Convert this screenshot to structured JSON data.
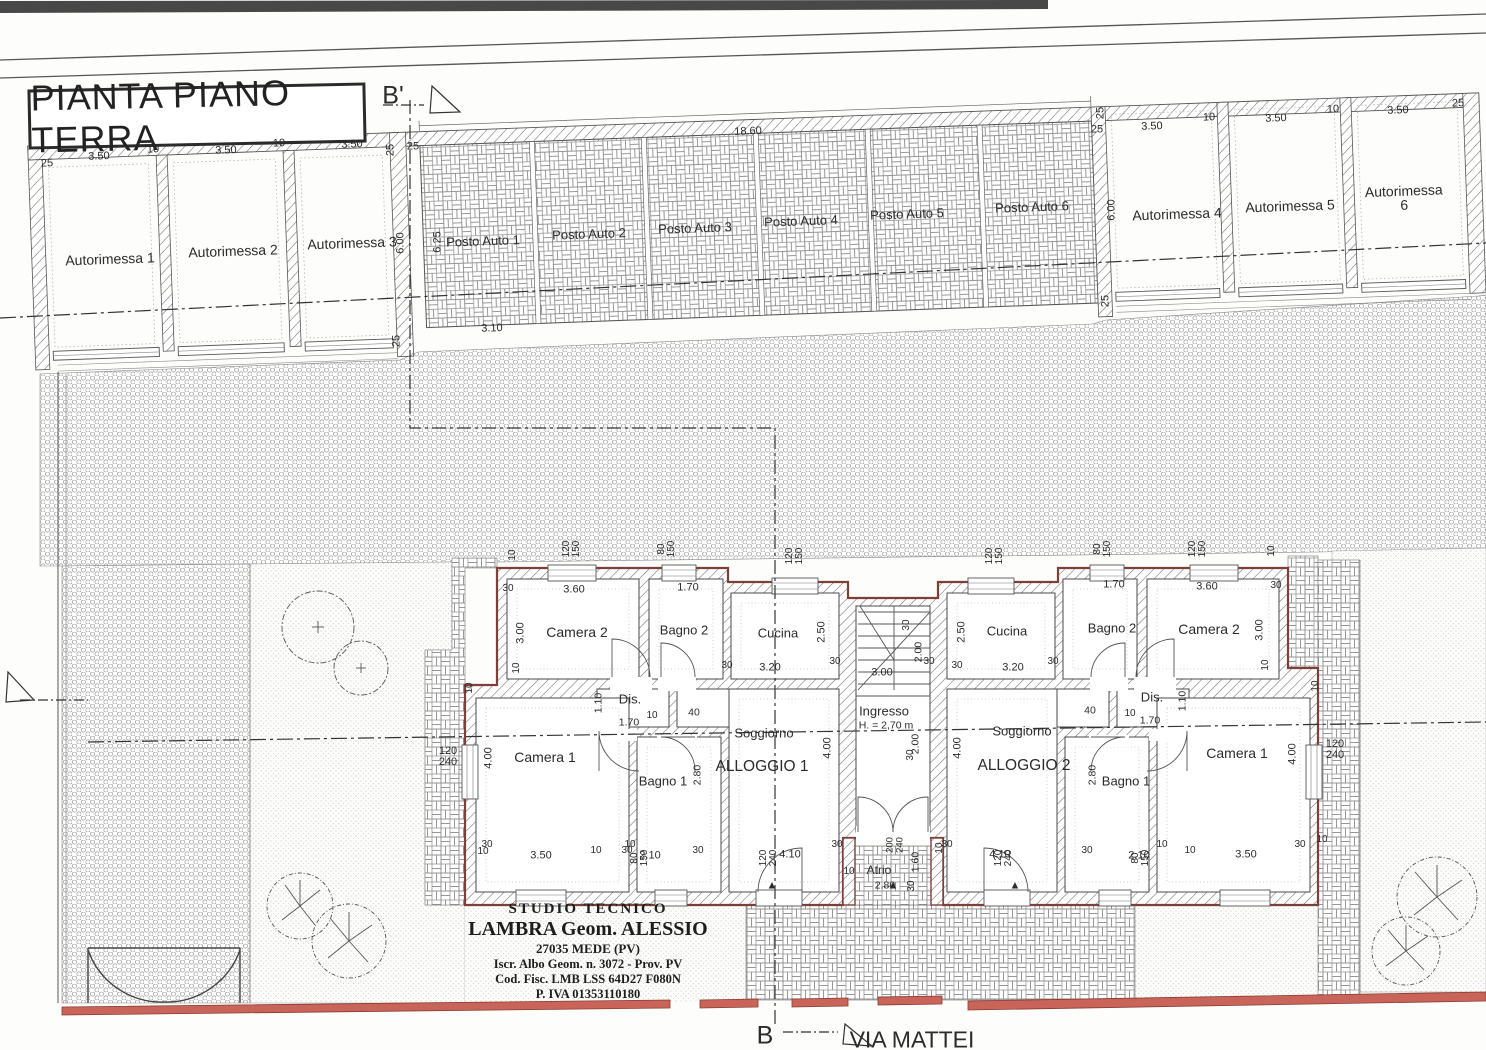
{
  "title": "PIANTA PIANO TERRA",
  "street": "VIA MATTEI",
  "section_markers": {
    "top": "B'",
    "bottom": "B"
  },
  "studio": {
    "line1": "STUDIO TECNICO",
    "line2": "LAMBRA Geom. ALESSIO",
    "line3": "27035 MEDE (PV)",
    "line4": "Iscr. Albo Geom. n. 3072 - Prov. PV",
    "line5": "Cod. Fisc. LMB LSS 64D27 F080N",
    "line6": "P. IVA 01353110180"
  },
  "garages": [
    "Autorimessa 1",
    "Autorimessa 2",
    "Autorimessa 3",
    "Autorimessa 4",
    "Autorimessa 5",
    "Autorimessa 6"
  ],
  "parking_spots": [
    "Posto Auto 1",
    "Posto Auto 2",
    "Posto Auto 3",
    "Posto Auto 4",
    "Posto Auto 5",
    "Posto Auto 6"
  ],
  "apartments": {
    "left": {
      "name": "ALLOGGIO 1",
      "rooms": [
        "Camera 1",
        "Camera 2",
        "Bagno 1",
        "Bagno 2",
        "Cucina",
        "Soggiorno",
        "Dis."
      ]
    },
    "right": {
      "name": "ALLOGGIO 2",
      "rooms": [
        "Camera 1",
        "Camera 2",
        "Bagno 1",
        "Bagno 2",
        "Cucina",
        "Soggiorno",
        "Dis."
      ]
    },
    "shared": [
      "Ingresso",
      "Atrio"
    ],
    "entry_height": "H. = 2,70 m"
  },
  "colors": {
    "wall_accent": "#7d4038",
    "fence": "#c8645a",
    "line": "#3a3a3a"
  },
  "labels": [
    {
      "t": "B'",
      "x": 393,
      "y": 96,
      "s": 25,
      "n": "section-marker-b-prime"
    },
    {
      "t": "B",
      "x": 765,
      "y": 1036,
      "s": 25,
      "n": "section-marker-b"
    },
    {
      "t": "VIA MATTEI",
      "x": 912,
      "y": 1040,
      "s": 23,
      "n": "street-label"
    },
    {
      "t": "25",
      "x": 47,
      "y": 164,
      "r": -2
    },
    {
      "t": "3.50",
      "x": 99,
      "y": 157,
      "r": -2
    },
    {
      "t": "10",
      "x": 153,
      "y": 150,
      "r": -2
    },
    {
      "t": "3.50",
      "x": 226,
      "y": 151,
      "r": -2
    },
    {
      "t": "10",
      "x": 279,
      "y": 144,
      "r": -2
    },
    {
      "t": "3.50",
      "x": 352,
      "y": 145,
      "r": -2
    },
    {
      "t": "25",
      "x": 391,
      "y": 150,
      "r": -90
    },
    {
      "t": "25",
      "x": 413,
      "y": 147
    },
    {
      "t": "6.00",
      "x": 401,
      "y": 243,
      "r": -90
    },
    {
      "t": "25",
      "x": 397,
      "y": 341,
      "r": -90
    },
    {
      "t": "Autorimessa 1",
      "x": 110,
      "y": 259,
      "r": -2,
      "s": 14,
      "n": "garage-1-label"
    },
    {
      "t": "Autorimessa 2",
      "x": 233,
      "y": 251,
      "r": -2,
      "s": 14,
      "n": "garage-2-label"
    },
    {
      "t": "Autorimessa 3",
      "x": 352,
      "y": 243,
      "r": -2,
      "s": 14,
      "n": "garage-3-label"
    },
    {
      "t": "6.25",
      "x": 438,
      "y": 242,
      "r": -90
    },
    {
      "t": "3.10",
      "x": 492,
      "y": 329,
      "r": -2
    },
    {
      "t": "18.60",
      "x": 748,
      "y": 132,
      "r": -2
    },
    {
      "t": "Posto Auto 1",
      "x": 483,
      "y": 241,
      "r": -2,
      "s": 13,
      "n": "parking-1-label"
    },
    {
      "t": "Posto Auto 2",
      "x": 589,
      "y": 234,
      "r": -2,
      "s": 13,
      "n": "parking-2-label"
    },
    {
      "t": "Posto Auto 3",
      "x": 695,
      "y": 228,
      "r": -2,
      "s": 13,
      "n": "parking-3-label"
    },
    {
      "t": "Posto Auto 4",
      "x": 801,
      "y": 221,
      "r": -2,
      "s": 13,
      "n": "parking-4-label"
    },
    {
      "t": "Posto Auto 5",
      "x": 907,
      "y": 214,
      "r": -2,
      "s": 13,
      "n": "parking-5-label"
    },
    {
      "t": "Posto Auto 6",
      "x": 1032,
      "y": 207,
      "r": -2,
      "s": 13,
      "n": "parking-6-label"
    },
    {
      "t": "25",
      "x": 1101,
      "y": 113,
      "r": -90
    },
    {
      "t": "25",
      "x": 1097,
      "y": 130
    },
    {
      "t": "6.00",
      "x": 1112,
      "y": 210,
      "r": -90
    },
    {
      "t": "3.50",
      "x": 1152,
      "y": 127,
      "r": -2
    },
    {
      "t": "10",
      "x": 1209,
      "y": 118,
      "r": -2
    },
    {
      "t": "3.50",
      "x": 1276,
      "y": 119,
      "r": -2
    },
    {
      "t": "10",
      "x": 1333,
      "y": 110,
      "r": -2
    },
    {
      "t": "3.50",
      "x": 1398,
      "y": 111,
      "r": -2
    },
    {
      "t": "25",
      "x": 1458,
      "y": 104,
      "r": -2
    },
    {
      "t": "25",
      "x": 1106,
      "y": 301,
      "r": -90
    },
    {
      "t": "Autorimessa 4",
      "x": 1177,
      "y": 214,
      "r": -2,
      "s": 14,
      "n": "garage-4-label"
    },
    {
      "t": "Autorimessa 5",
      "x": 1290,
      "y": 206,
      "r": -2,
      "s": 14,
      "n": "garage-5-label"
    },
    {
      "t": "Autorimessa 6",
      "x": 1404,
      "y": 198,
      "r": -2,
      "s": 14,
      "n": "garage-6-label"
    },
    {
      "t": "120\n150",
      "x": 572,
      "y": 549,
      "r": -90,
      "s": 10
    },
    {
      "t": "80\n150",
      "x": 667,
      "y": 549,
      "r": -90,
      "s": 10
    },
    {
      "t": "120\n150",
      "x": 795,
      "y": 556,
      "r": -90,
      "s": 10
    },
    {
      "t": "120\n150",
      "x": 995,
      "y": 556,
      "r": -90,
      "s": 10
    },
    {
      "t": "80\n150",
      "x": 1103,
      "y": 549,
      "r": -90,
      "s": 10
    },
    {
      "t": "120\n150",
      "x": 1198,
      "y": 549,
      "r": -90,
      "s": 10
    },
    {
      "t": "10",
      "x": 513,
      "y": 555,
      "r": -90,
      "s": 10
    },
    {
      "t": "10",
      "x": 1272,
      "y": 551,
      "r": -90,
      "s": 10
    },
    {
      "t": "Camera 2",
      "x": 577,
      "y": 632,
      "s": 14,
      "n": "room-camera2-left"
    },
    {
      "t": "3.60",
      "x": 574,
      "y": 590
    },
    {
      "t": "3.00",
      "x": 521,
      "y": 633,
      "r": -90
    },
    {
      "t": "30",
      "x": 508,
      "y": 589,
      "s": 10
    },
    {
      "t": "10",
      "x": 517,
      "y": 668,
      "r": -90,
      "s": 10
    },
    {
      "t": "Bagno 2",
      "x": 684,
      "y": 630,
      "s": 13,
      "n": "room-bagno2-left"
    },
    {
      "t": "1.70",
      "x": 688,
      "y": 588
    },
    {
      "t": "Cucina",
      "x": 778,
      "y": 633,
      "s": 13,
      "n": "room-cucina-left"
    },
    {
      "t": "3.20",
      "x": 770,
      "y": 668
    },
    {
      "t": "2.50",
      "x": 822,
      "y": 632,
      "r": -90
    },
    {
      "t": "30",
      "x": 727,
      "y": 666,
      "s": 10
    },
    {
      "t": "30",
      "x": 835,
      "y": 662,
      "s": 10
    },
    {
      "t": "Dis.",
      "x": 630,
      "y": 699,
      "s": 13,
      "n": "room-dis-left"
    },
    {
      "t": "1.70",
      "x": 629,
      "y": 723,
      "s": 10.5
    },
    {
      "t": "1.10",
      "x": 599,
      "y": 703,
      "r": -90,
      "s": 10.5
    },
    {
      "t": "10",
      "x": 652,
      "y": 716,
      "s": 10
    },
    {
      "t": "40",
      "x": 694,
      "y": 713,
      "s": 10.5
    },
    {
      "t": "Soggiorno",
      "x": 764,
      "y": 733,
      "s": 13,
      "n": "room-soggiorno-left"
    },
    {
      "t": "ALLOGGIO 1",
      "x": 762,
      "y": 767,
      "s": 15.5,
      "n": "apartment-1-label"
    },
    {
      "t": "4.10",
      "x": 790,
      "y": 855
    },
    {
      "t": "4.00",
      "x": 828,
      "y": 748,
      "r": -90
    },
    {
      "t": "Camera 1",
      "x": 545,
      "y": 757,
      "s": 14,
      "n": "room-camera1-left"
    },
    {
      "t": "4.00",
      "x": 489,
      "y": 758,
      "r": -90
    },
    {
      "t": "3.50",
      "x": 541,
      "y": 856
    },
    {
      "t": "30",
      "x": 487,
      "y": 845,
      "s": 10
    },
    {
      "t": "10",
      "x": 596,
      "y": 851,
      "s": 10
    },
    {
      "t": "Bagno 1",
      "x": 663,
      "y": 781,
      "s": 13,
      "n": "room-bagno1-left"
    },
    {
      "t": "2.80",
      "x": 698,
      "y": 775,
      "r": -90,
      "s": 10.5
    },
    {
      "t": "2.10",
      "x": 650,
      "y": 856
    },
    {
      "t": "10",
      "x": 630,
      "y": 845,
      "s": 10
    },
    {
      "t": "Ingresso",
      "x": 884,
      "y": 711,
      "s": 13,
      "n": "room-ingresso"
    },
    {
      "t": "H. = 2,70 m",
      "x": 886,
      "y": 726,
      "s": 10.5,
      "n": "entry-height-label"
    },
    {
      "t": "3.00",
      "x": 882,
      "y": 673
    },
    {
      "t": "2.00",
      "x": 919,
      "y": 652,
      "r": -90,
      "s": 10.5
    },
    {
      "t": "2.00",
      "x": 916,
      "y": 744,
      "r": -90,
      "s": 10.5
    },
    {
      "t": "30",
      "x": 907,
      "y": 625,
      "r": -90,
      "s": 10
    },
    {
      "t": "30",
      "x": 929,
      "y": 662,
      "s": 10
    },
    {
      "t": "30",
      "x": 911,
      "y": 755,
      "r": -90,
      "s": 10
    },
    {
      "t": "Atrio",
      "x": 879,
      "y": 870,
      "s": 12,
      "n": "room-atrio"
    },
    {
      "t": "2.80",
      "x": 885,
      "y": 886,
      "s": 10.5
    },
    {
      "t": "1.60",
      "x": 916,
      "y": 862,
      "r": -90,
      "s": 10.5
    },
    {
      "t": "200\n240",
      "x": 895,
      "y": 845,
      "r": -90,
      "s": 9.5
    },
    {
      "t": "10",
      "x": 940,
      "y": 848,
      "r": -90,
      "s": 10
    },
    {
      "t": "10",
      "x": 849,
      "y": 872,
      "s": 10
    },
    {
      "t": "30",
      "x": 912,
      "y": 886,
      "r": -90,
      "s": 10
    },
    {
      "t": "Cucina",
      "x": 1007,
      "y": 631,
      "s": 13,
      "n": "room-cucina-right"
    },
    {
      "t": "3.20",
      "x": 1013,
      "y": 668
    },
    {
      "t": "2.50",
      "x": 962,
      "y": 632,
      "r": -90
    },
    {
      "t": "30",
      "x": 957,
      "y": 666,
      "s": 10
    },
    {
      "t": "30",
      "x": 1053,
      "y": 662,
      "s": 10
    },
    {
      "t": "Bagno 2",
      "x": 1112,
      "y": 628,
      "s": 13,
      "n": "room-bagno2-right"
    },
    {
      "t": "1.70",
      "x": 1114,
      "y": 585
    },
    {
      "t": "Camera 2",
      "x": 1209,
      "y": 629,
      "s": 14,
      "n": "room-camera2-right"
    },
    {
      "t": "3.60",
      "x": 1207,
      "y": 587
    },
    {
      "t": "3.00",
      "x": 1260,
      "y": 630,
      "r": -90
    },
    {
      "t": "30",
      "x": 1276,
      "y": 586,
      "s": 10
    },
    {
      "t": "10",
      "x": 1266,
      "y": 665,
      "r": -90,
      "s": 10
    },
    {
      "t": "Dis.",
      "x": 1152,
      "y": 697,
      "s": 13,
      "n": "room-dis-right"
    },
    {
      "t": "1.70",
      "x": 1150,
      "y": 721,
      "s": 10.5
    },
    {
      "t": "1.10",
      "x": 1183,
      "y": 701,
      "r": -90,
      "s": 10.5
    },
    {
      "t": "10",
      "x": 1130,
      "y": 714,
      "s": 10
    },
    {
      "t": "40",
      "x": 1090,
      "y": 711,
      "s": 10.5
    },
    {
      "t": "Soggiorno",
      "x": 1022,
      "y": 731,
      "s": 13,
      "n": "room-soggiorno-right"
    },
    {
      "t": "ALLOGGIO 2",
      "x": 1024,
      "y": 766,
      "s": 15.5,
      "n": "apartment-2-label"
    },
    {
      "t": "4.10",
      "x": 1000,
      "y": 855
    },
    {
      "t": "4.00",
      "x": 958,
      "y": 748,
      "r": -90
    },
    {
      "t": "Camera 1",
      "x": 1237,
      "y": 753,
      "s": 14,
      "n": "room-camera1-right"
    },
    {
      "t": "4.00",
      "x": 1293,
      "y": 754,
      "r": -90
    },
    {
      "t": "3.50",
      "x": 1246,
      "y": 855
    },
    {
      "t": "30",
      "x": 1300,
      "y": 845,
      "s": 10
    },
    {
      "t": "10",
      "x": 1322,
      "y": 840,
      "s": 10
    },
    {
      "t": "Bagno 1",
      "x": 1126,
      "y": 781,
      "s": 13,
      "n": "room-bagno1-right"
    },
    {
      "t": "2.80",
      "x": 1093,
      "y": 775,
      "r": -90,
      "s": 10.5
    },
    {
      "t": "2.10",
      "x": 1139,
      "y": 856
    },
    {
      "t": "10",
      "x": 1162,
      "y": 845,
      "s": 10
    },
    {
      "t": "120\n240",
      "x": 448,
      "y": 757,
      "s": 11
    },
    {
      "t": "120\n240",
      "x": 1335,
      "y": 750,
      "s": 11
    },
    {
      "t": "80\n150",
      "x": 640,
      "y": 858,
      "r": -90,
      "s": 10
    },
    {
      "t": "120\n240",
      "x": 769,
      "y": 858,
      "r": -90,
      "s": 10
    },
    {
      "t": "120\n240",
      "x": 1004,
      "y": 858,
      "r": -90,
      "s": 10
    },
    {
      "t": "80\n150",
      "x": 1141,
      "y": 858,
      "r": -90,
      "s": 10
    },
    {
      "t": "10",
      "x": 483,
      "y": 852,
      "s": 10
    },
    {
      "t": "30",
      "x": 627,
      "y": 851,
      "s": 10
    },
    {
      "t": "30",
      "x": 698,
      "y": 851,
      "s": 10
    },
    {
      "t": "30",
      "x": 837,
      "y": 845,
      "s": 10
    },
    {
      "t": "30",
      "x": 947,
      "y": 845,
      "s": 10
    },
    {
      "t": "30",
      "x": 1087,
      "y": 851,
      "s": 10
    },
    {
      "t": "10",
      "x": 1190,
      "y": 851,
      "s": 10
    },
    {
      "t": "10",
      "x": 470,
      "y": 688,
      "r": -90,
      "s": 10
    },
    {
      "t": "10",
      "x": 1316,
      "y": 686,
      "r": -90,
      "s": 10
    },
    {
      "t": "▲",
      "x": 772,
      "y": 886,
      "s": 11,
      "n": "entrance-marker"
    },
    {
      "t": "▲",
      "x": 893,
      "y": 886,
      "s": 11,
      "n": "entrance-marker"
    },
    {
      "t": "▲",
      "x": 1015,
      "y": 886,
      "s": 11,
      "n": "entrance-marker"
    }
  ]
}
